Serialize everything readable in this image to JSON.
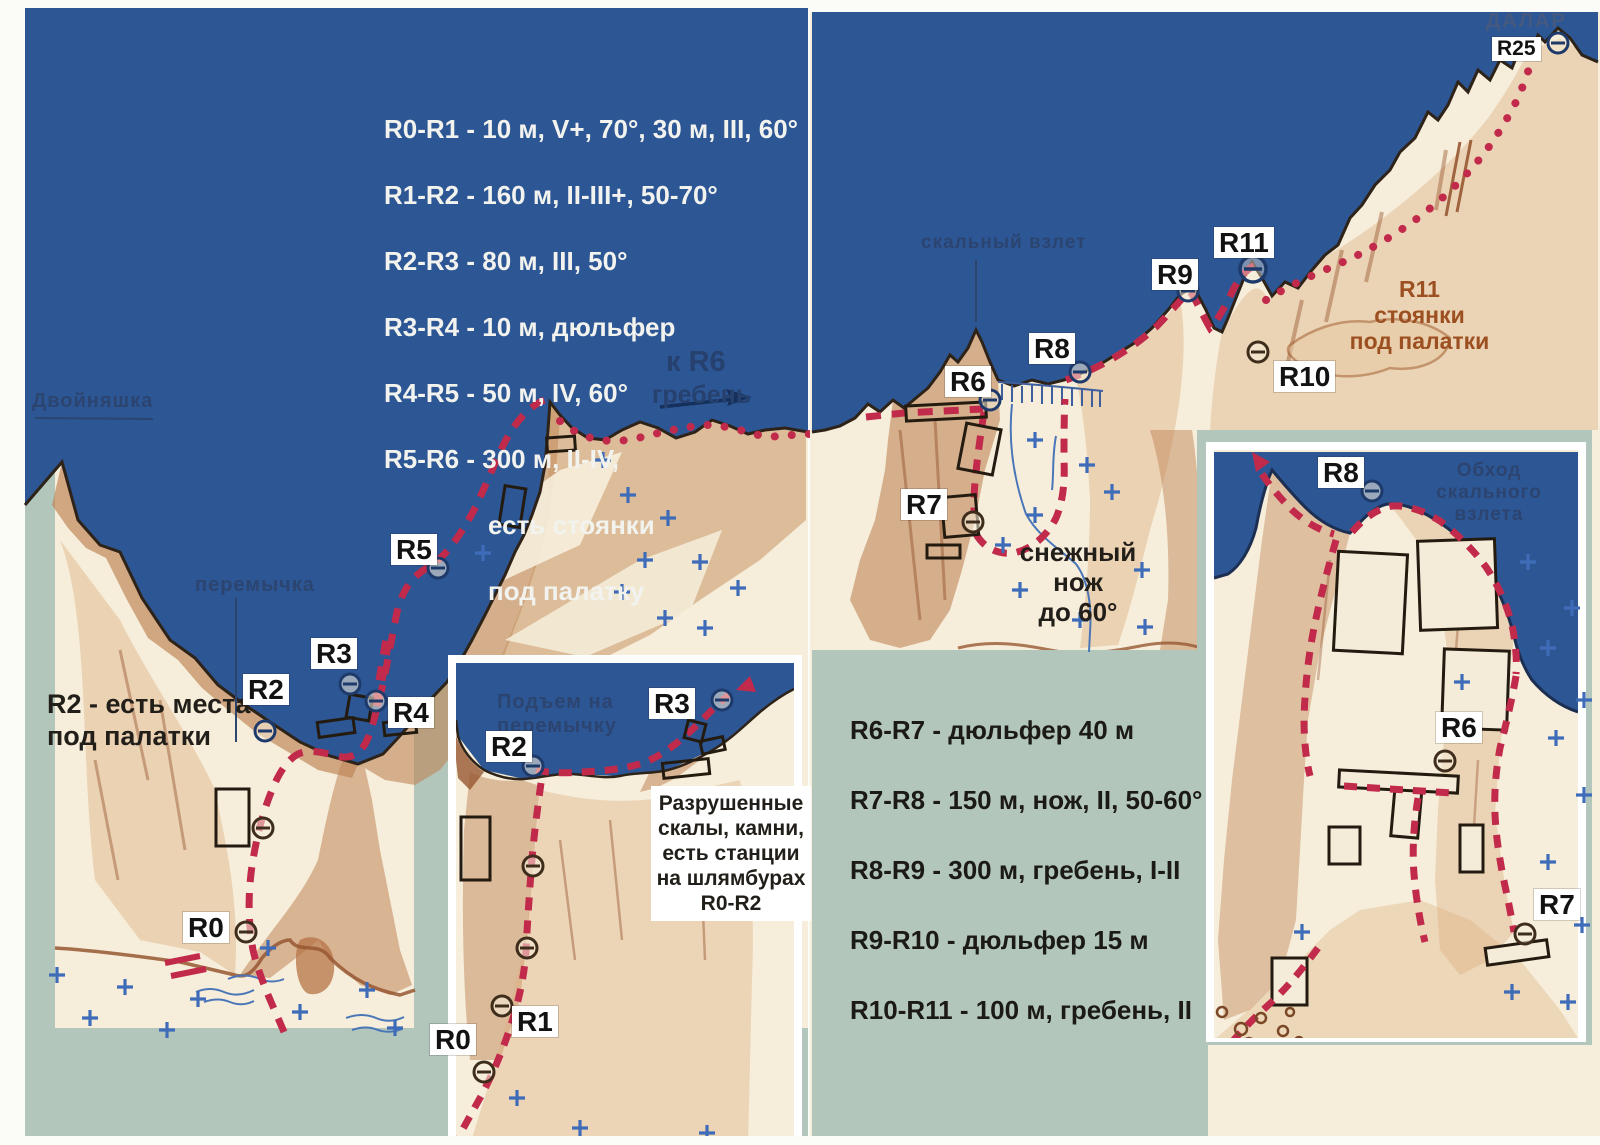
{
  "colors": {
    "sky": "#2d5695",
    "rock_cream": "#f6eedb",
    "rock_tan": "#c08557",
    "rock_dark": "#975731",
    "sage": "#b2c6bc",
    "route_red": "#c12a4a",
    "navy_text": "#27416f",
    "brown_text": "#9c5021",
    "snow_mark_blue": "#3f6cb8"
  },
  "legend_left": {
    "lines": [
      "R0-R1 - 10 м, V+, 70°, 30 м, III, 60°",
      "R1-R2 - 160 м, II-III+, 50-70°",
      "R2-R3 - 80 м, III, 50°",
      "R3-R4 - 10 м, дюльфер",
      "R4-R5 - 50 м, IV, 60°",
      "R5-R6 - 300 м, II-IV,",
      "есть стоянки",
      "под палатку"
    ]
  },
  "legend_right": {
    "lines": [
      "R6-R7 - дюльфер 40 м",
      "R7-R8 - 150 м, нож, II, 50-60°",
      "R8-R9 - 300 м, гребень, I-II",
      "R9-R10 - дюльфер 15 м",
      "R10-R11 - 100 м, гребень, II"
    ]
  },
  "labels": {
    "dvoynyashka": "Двойняшка",
    "peremychka": "перемычка",
    "skalny_vzlet": "скальный взлет",
    "k_r6": "к R6",
    "greben": "гребень",
    "r2_note": "R2 - есть места\nпод палатки",
    "snow_knife": "снежный нож\nдо 60°",
    "r11_note": "R11\nстоянки\nпод палатки",
    "dalar": "ДАЛАР",
    "inset1_title": "Подъем на\nперемычку",
    "inset1_note": "Разрушенные\nскалы, камни,\nесть станции\nна шлямбурах\nR0-R2",
    "inset2_title": "Обход скального\nвзлета"
  },
  "markers": {
    "main": {
      "r0": "R0",
      "r2": "R2",
      "r3": "R3",
      "r4": "R4",
      "r5": "R5",
      "r6": "R6",
      "r7": "R7",
      "r8": "R8",
      "r9": "R9",
      "r10": "R10",
      "r11": "R11",
      "r25": "R25"
    },
    "inset1": {
      "r0": "R0",
      "r1": "R1",
      "r2": "R2",
      "r3": "R3"
    },
    "inset2": {
      "r6": "R6",
      "r7": "R7",
      "r8": "R8"
    }
  }
}
